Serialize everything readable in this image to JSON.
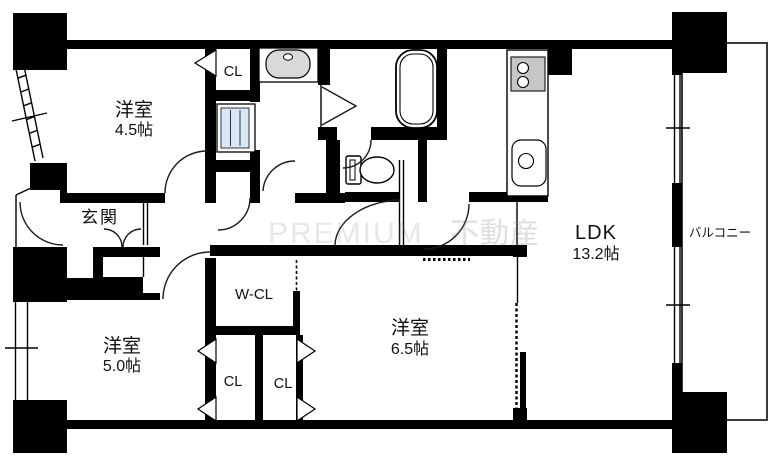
{
  "plan": {
    "rooms": {
      "bedroom45": {
        "name": "洋室",
        "size": "4.5帖"
      },
      "bedroom50": {
        "name": "洋室",
        "size": "5.0帖"
      },
      "bedroom65": {
        "name": "洋室",
        "size": "6.5帖"
      },
      "ldk": {
        "name": "LDK",
        "size": "13.2帖"
      },
      "entrance": {
        "name": "玄関"
      },
      "balcony": {
        "name": "バルコニー"
      },
      "walkin_closet": {
        "name": "W-CL"
      },
      "closet_top": {
        "name": "CL"
      },
      "closet_left": {
        "name": "CL"
      },
      "closet_right": {
        "name": "CL"
      }
    },
    "watermark": {
      "latin": "PREMIUM",
      "kanji": "不動産"
    },
    "colors": {
      "wall": "#000000",
      "background": "#ffffff",
      "washing_machine": "#d9e8f8",
      "basin_bowl": "#d9d9d9",
      "stove": "#c6c6c6",
      "balcony_outline": "#3a3a3a",
      "watermark": "#8a8a8a"
    }
  }
}
